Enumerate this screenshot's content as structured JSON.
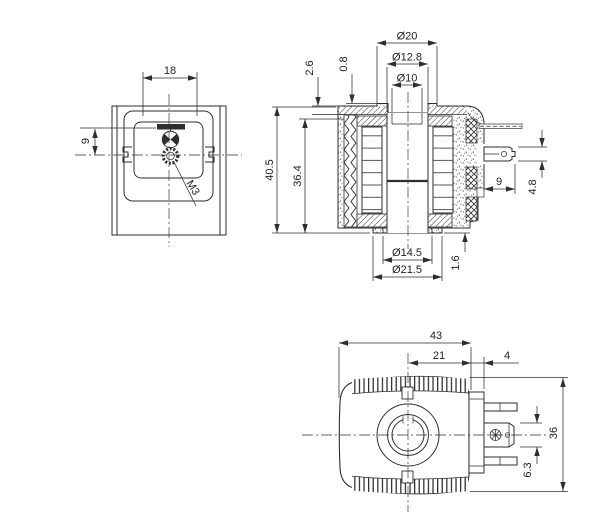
{
  "front_view": {
    "dim_mount_width": "18",
    "dim_center_offset": "9",
    "thread_callout": "M3"
  },
  "section_view": {
    "dim_dia_outer": "Ø20",
    "dim_dia_mid": "Ø12.8",
    "dim_dia_bore": "Ø10",
    "dim_top_step": "2.6",
    "dim_top_lip": "0.8",
    "dim_height_total": "40.5",
    "dim_height_inner": "36.4",
    "dim_terminal_length": "9",
    "dim_terminal_height": "4.8",
    "dim_bottom_lip": "1.6",
    "dim_dia_boss_inner": "Ø14.5",
    "dim_dia_boss_outer": "Ø21.5"
  },
  "top_view": {
    "dim_width_total": "43",
    "dim_center_to_edge": "21",
    "dim_connector_offset": "4",
    "dim_depth_total": "36",
    "dim_ground_terminal_width": "6.3"
  }
}
